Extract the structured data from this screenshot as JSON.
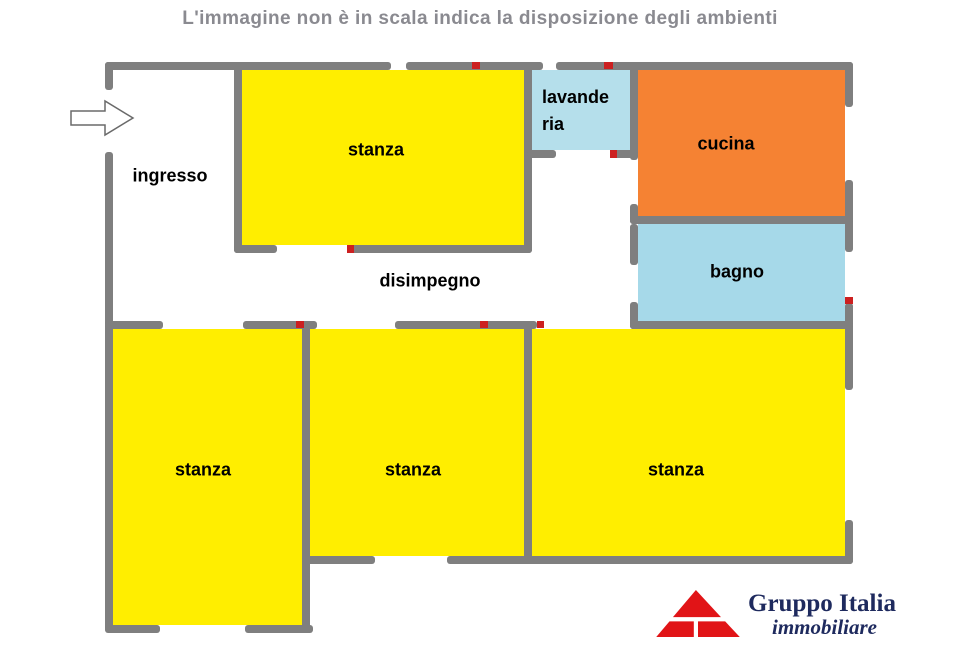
{
  "title": "L'immagine non è in scala indica la disposizione degli ambienti",
  "rooms": {
    "ingresso": {
      "label": "ingresso"
    },
    "stanza_top": {
      "label": "stanza"
    },
    "lavanderia": {
      "label": "lavanderia",
      "line1": "lavande",
      "line2": "ria"
    },
    "cucina": {
      "label": "cucina"
    },
    "bagno": {
      "label": "bagno"
    },
    "disimpegno": {
      "label": "disimpegno"
    },
    "stanza_bottom_left": {
      "label": "stanza"
    },
    "stanza_bottom_middle": {
      "label": "stanza"
    },
    "stanza_bottom_right": {
      "label": "stanza"
    }
  },
  "logo": {
    "company": "Gruppo Italia",
    "tagline": "immobiliare"
  },
  "colors": {
    "title_text": "#8a8a90",
    "wall_gray": "#7f7f7f",
    "room_yellow": "#ffee00",
    "room_orange": "#f58233",
    "room_lavanderia_blue": "#b5dfeb",
    "room_bagno_blue": "#a6d9e9",
    "door_marker_red": "#cc2020",
    "logo_red": "#e11417",
    "logo_navy": "#1e2a5e"
  }
}
